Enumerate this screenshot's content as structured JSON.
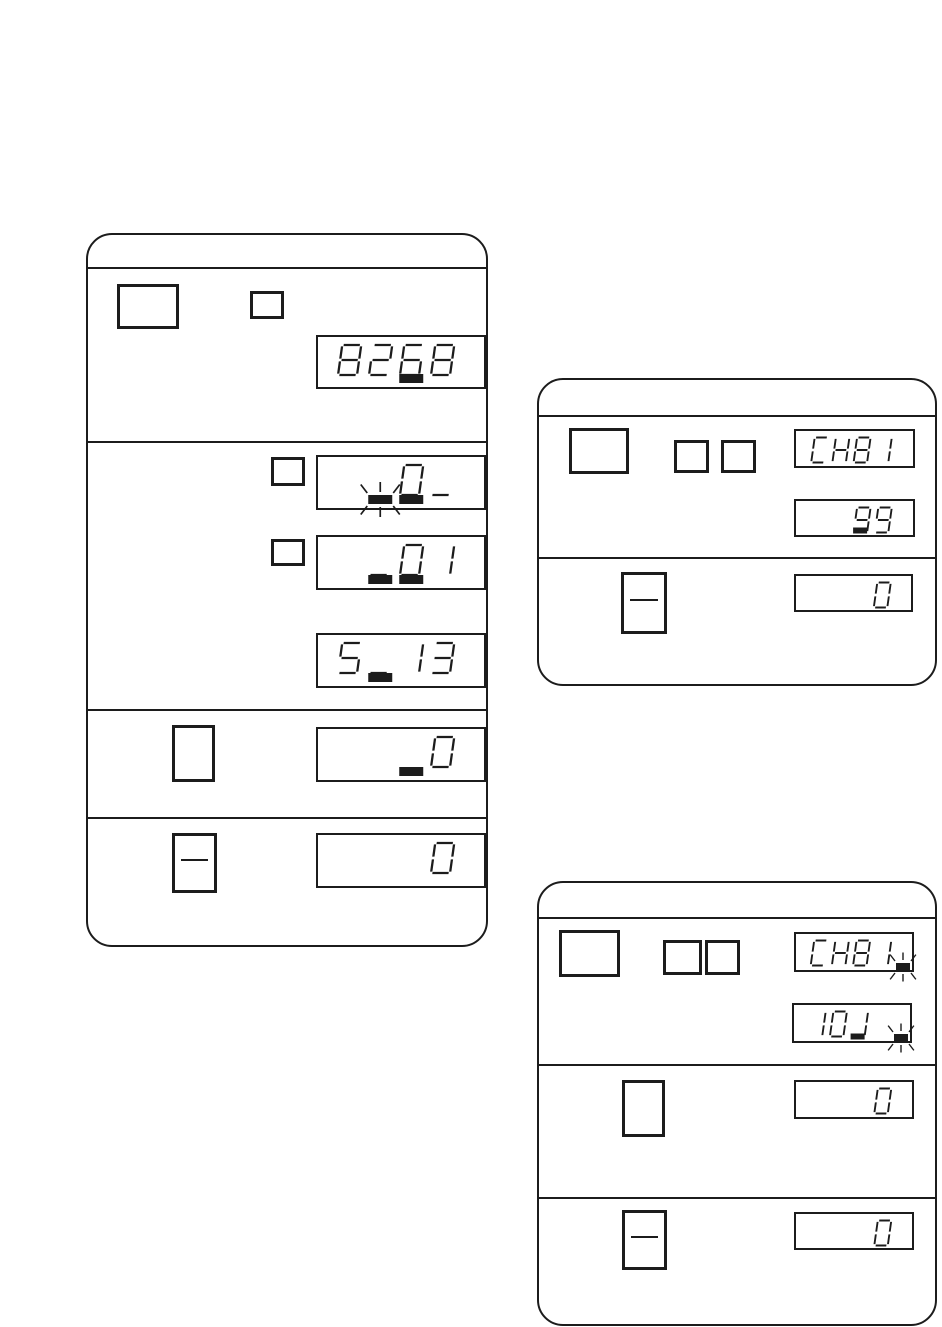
{
  "colors": {
    "ink": "#1c1c1c",
    "paper": "#ffffff"
  },
  "displays": {
    "left_top": {
      "size": "lg",
      "value": "8268",
      "cells": [
        {
          "ch": "8"
        },
        {
          "ch": "2"
        },
        {
          "ch": "6",
          "cursor": true
        },
        {
          "ch": "8"
        }
      ]
    },
    "left_a": {
      "size": "lg",
      "value": "0_",
      "cells": [
        {
          "ch": " "
        },
        {
          "ch": " ",
          "blink": true
        },
        {
          "ch": "0",
          "cursor": true
        },
        {
          "ch": "_"
        }
      ]
    },
    "left_b": {
      "size": "lg",
      "value": "01",
      "cells": [
        {
          "ch": " "
        },
        {
          "ch": "_",
          "cursor": true
        },
        {
          "ch": "0",
          "cursor": true
        },
        {
          "ch": "1"
        }
      ]
    },
    "left_c": {
      "size": "lg",
      "value": "5 13",
      "cells": [
        {
          "ch": "5"
        },
        {
          "ch": "_",
          "cursor": true
        },
        {
          "ch": "1"
        },
        {
          "ch": "3"
        }
      ]
    },
    "left_d": {
      "size": "lg",
      "value": "0",
      "cells": [
        {
          "ch": " "
        },
        {
          "ch": " "
        },
        {
          "ch": " ",
          "cursor": true
        },
        {
          "ch": "0"
        }
      ]
    },
    "left_e": {
      "size": "lg",
      "value": "0",
      "cells": [
        {
          "ch": " "
        },
        {
          "ch": " "
        },
        {
          "ch": " "
        },
        {
          "ch": "0"
        }
      ]
    },
    "tr_ch": {
      "size": "sm",
      "value": "CH81",
      "cells": [
        {
          "ch": "C"
        },
        {
          "ch": "H"
        },
        {
          "ch": "8"
        },
        {
          "ch": "1"
        }
      ]
    },
    "tr_99": {
      "size": "sm",
      "value": "99",
      "cells": [
        {
          "ch": " "
        },
        {
          "ch": " "
        },
        {
          "ch": "9",
          "cursor": true
        },
        {
          "ch": "9"
        }
      ]
    },
    "tr_0": {
      "size": "sm",
      "value": "0",
      "cells": [
        {
          "ch": " "
        },
        {
          "ch": " "
        },
        {
          "ch": " "
        },
        {
          "ch": "0"
        }
      ]
    },
    "br_ch": {
      "size": "sm",
      "value": "CH81",
      "tail_blink": true,
      "cells": [
        {
          "ch": "C"
        },
        {
          "ch": "H"
        },
        {
          "ch": "8"
        },
        {
          "ch": "1"
        }
      ]
    },
    "br_101": {
      "size": "sm",
      "value": "101",
      "tail_blink": true,
      "cells": [
        {
          "ch": "1"
        },
        {
          "ch": "0"
        },
        {
          "ch": "1",
          "cursor": true
        },
        {
          "ch": " "
        }
      ]
    },
    "br_0a": {
      "size": "sm",
      "value": "0",
      "cells": [
        {
          "ch": " "
        },
        {
          "ch": " "
        },
        {
          "ch": " "
        },
        {
          "ch": "0"
        }
      ]
    },
    "br_0b": {
      "size": "sm",
      "value": "0",
      "cells": [
        {
          "ch": " "
        },
        {
          "ch": " "
        },
        {
          "ch": " "
        },
        {
          "ch": "0"
        }
      ]
    }
  },
  "keys": {
    "left_large": {
      "glyph": "blank"
    },
    "left_small_top": {
      "glyph": "blank"
    },
    "left_small_a": {
      "glyph": "blank"
    },
    "left_small_b": {
      "glyph": "blank"
    },
    "left_key_plain": {
      "glyph": "blank"
    },
    "left_key_minus": {
      "glyph": "minus"
    },
    "tr_large": {
      "glyph": "blank"
    },
    "tr_small_1": {
      "glyph": "blank"
    },
    "tr_small_2": {
      "glyph": "blank"
    },
    "tr_key_minus": {
      "glyph": "minus"
    },
    "br_large": {
      "glyph": "blank"
    },
    "br_small_1": {
      "glyph": "blank"
    },
    "br_small_2": {
      "glyph": "blank"
    },
    "br_key_plain": {
      "glyph": "blank"
    },
    "br_key_minus": {
      "glyph": "minus"
    }
  }
}
